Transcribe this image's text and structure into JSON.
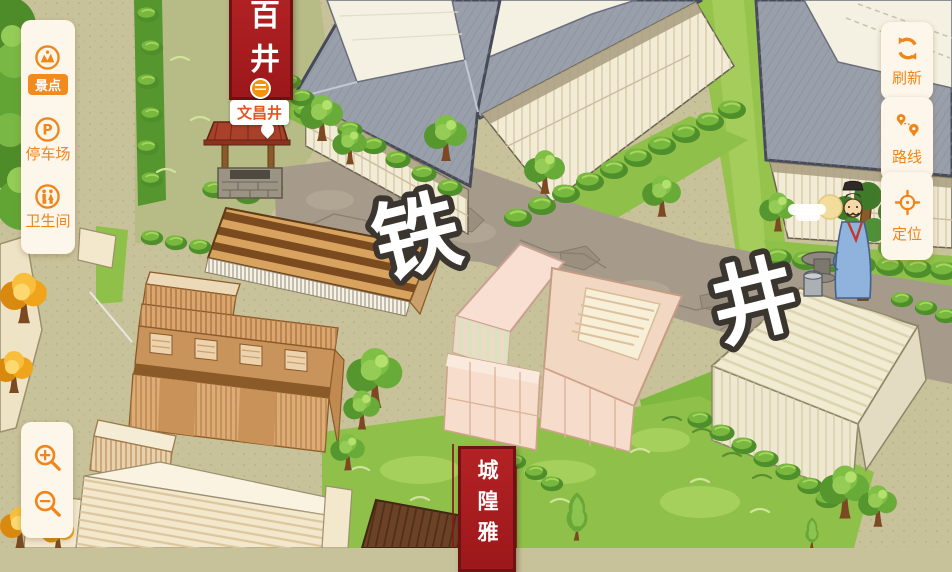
{
  "left_toolbar": {
    "items": [
      {
        "label": "景点",
        "icon": "scenic-spots-icon",
        "active": true
      },
      {
        "label": "停车场",
        "icon": "parking-icon",
        "icon_glyph": "P",
        "active": false
      },
      {
        "label": "卫生间",
        "icon": "restroom-icon",
        "active": false
      }
    ]
  },
  "right_toolbar": {
    "refresh": {
      "label": "刷新",
      "icon": "refresh-icon"
    },
    "route": {
      "label": "路线",
      "icon": "route-icon"
    },
    "locate": {
      "label": "定位",
      "icon": "locate-icon"
    }
  },
  "zoom_controls": {
    "zoom_in_icon": "magnifier-plus-icon",
    "zoom_out_icon": "magnifier-minus-icon"
  },
  "map": {
    "street_name_chars": {
      "char1": "铁",
      "char2": "井"
    },
    "top_banner_text": "百井",
    "bottom_banner_text": "城隍雅",
    "poi": {
      "label": "文昌井",
      "marker_icon": "well-marker-icon"
    }
  },
  "colors": {
    "accent_orange": "#f08519",
    "banner_red": "#a91e20",
    "ground": "#c8c29a",
    "road_gray": "#a69b8b",
    "grass_green": "#8fc04a"
  }
}
